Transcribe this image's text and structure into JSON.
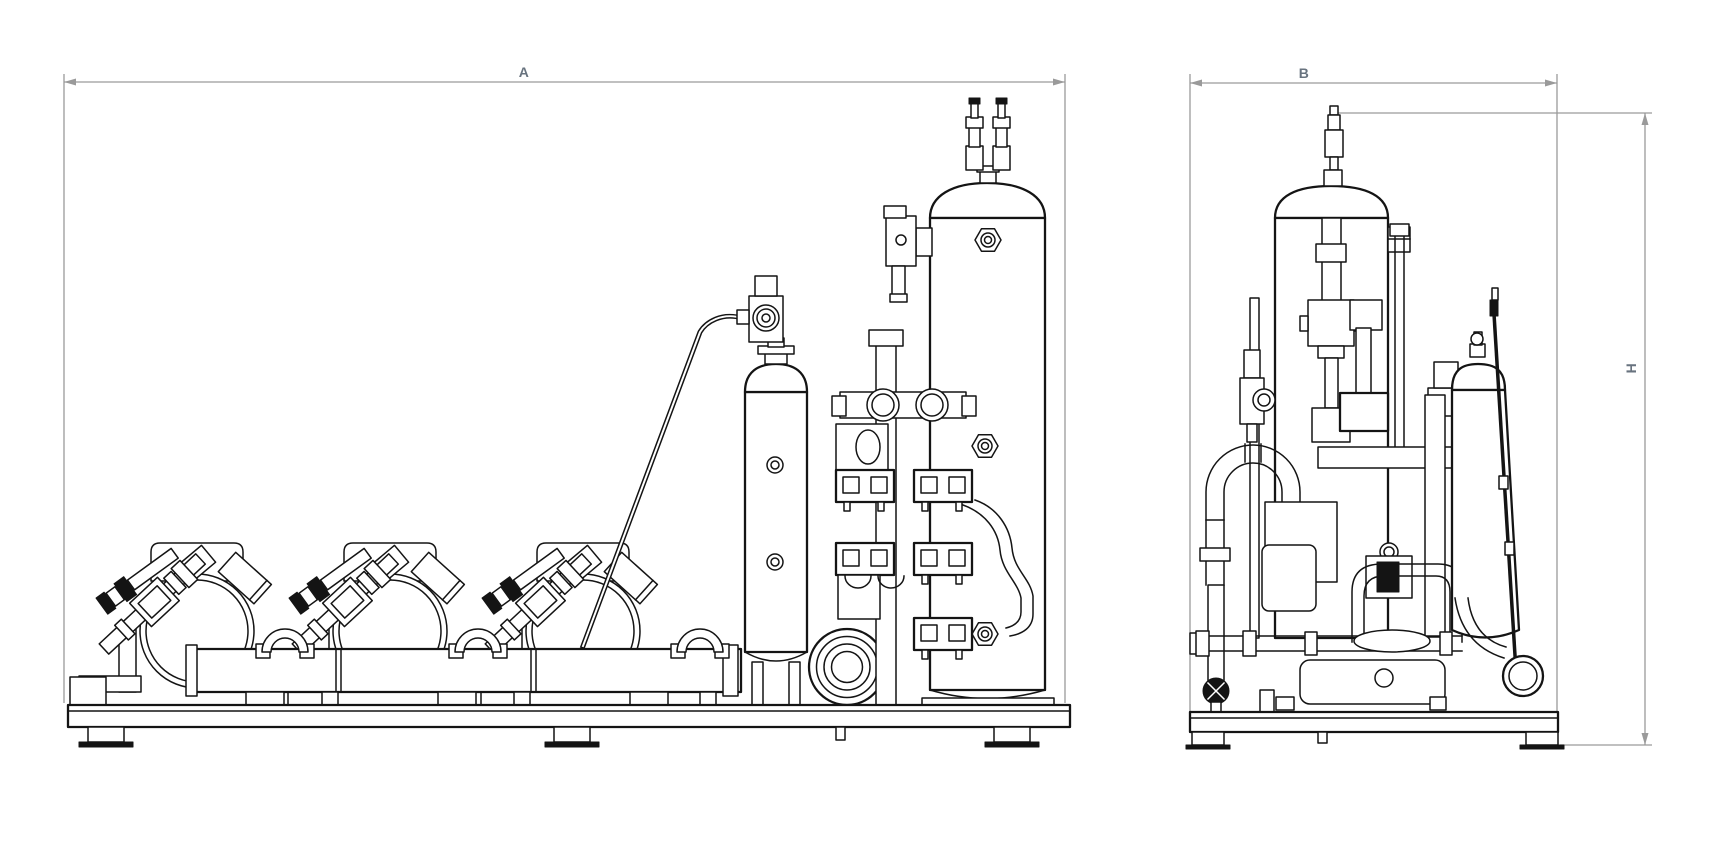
{
  "drawing_labels": {
    "a": {
      "label": "A"
    },
    "b": {
      "label": "B"
    },
    "h": {
      "label": "H"
    }
  },
  "colors": {
    "line": "#141414",
    "dimension_line": "#9a9a9a",
    "dimension_label": "#68737f",
    "background": "#ffffff"
  }
}
